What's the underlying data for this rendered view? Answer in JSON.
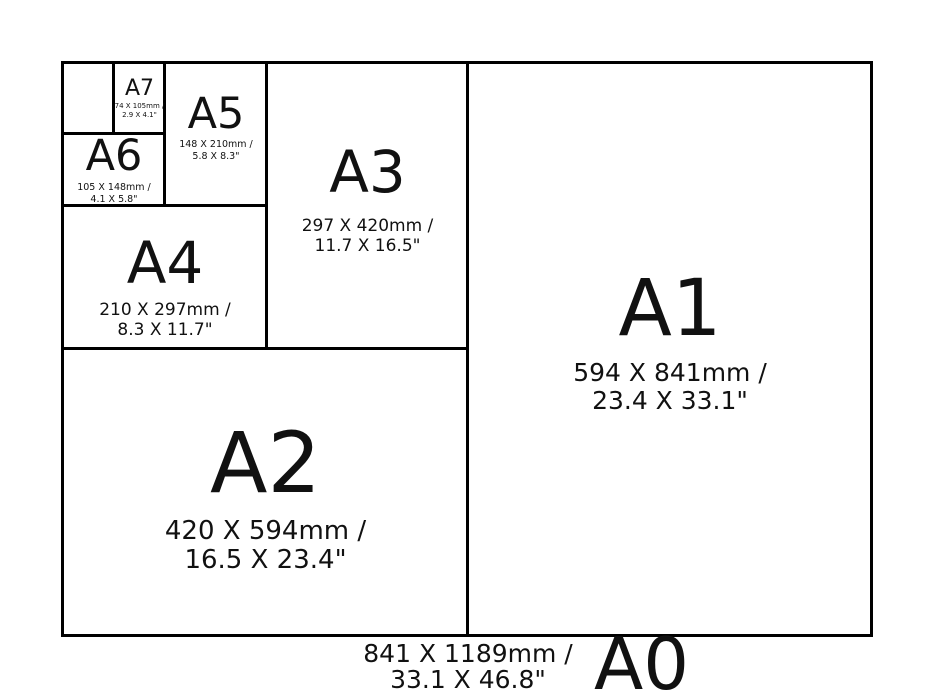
{
  "colors": {
    "background": "#ffffff",
    "line": "#000000",
    "text": "#111111"
  },
  "sizes": {
    "a0": {
      "label": "A0",
      "mm": "841 X 1189mm /",
      "inches": "33.1 X 46.8\""
    },
    "a1": {
      "label": "A1",
      "mm": "594 X 841mm /",
      "inches": "23.4 X 33.1\""
    },
    "a2": {
      "label": "A2",
      "mm": "420 X 594mm /",
      "inches": "16.5 X 23.4\""
    },
    "a3": {
      "label": "A3",
      "mm": "297 X 420mm /",
      "inches": "11.7 X 16.5\""
    },
    "a4": {
      "label": "A4",
      "mm": "210 X 297mm /",
      "inches": "8.3 X 11.7\""
    },
    "a5": {
      "label": "A5",
      "mm": "148 X 210mm /",
      "inches": "5.8 X 8.3\""
    },
    "a6": {
      "label": "A6",
      "mm": "105 X 148mm /",
      "inches": "4.1 X 5.8\""
    },
    "a7": {
      "label": "A7",
      "mm": "74 X 105mm /",
      "inches": "2.9 X 4.1\""
    }
  }
}
